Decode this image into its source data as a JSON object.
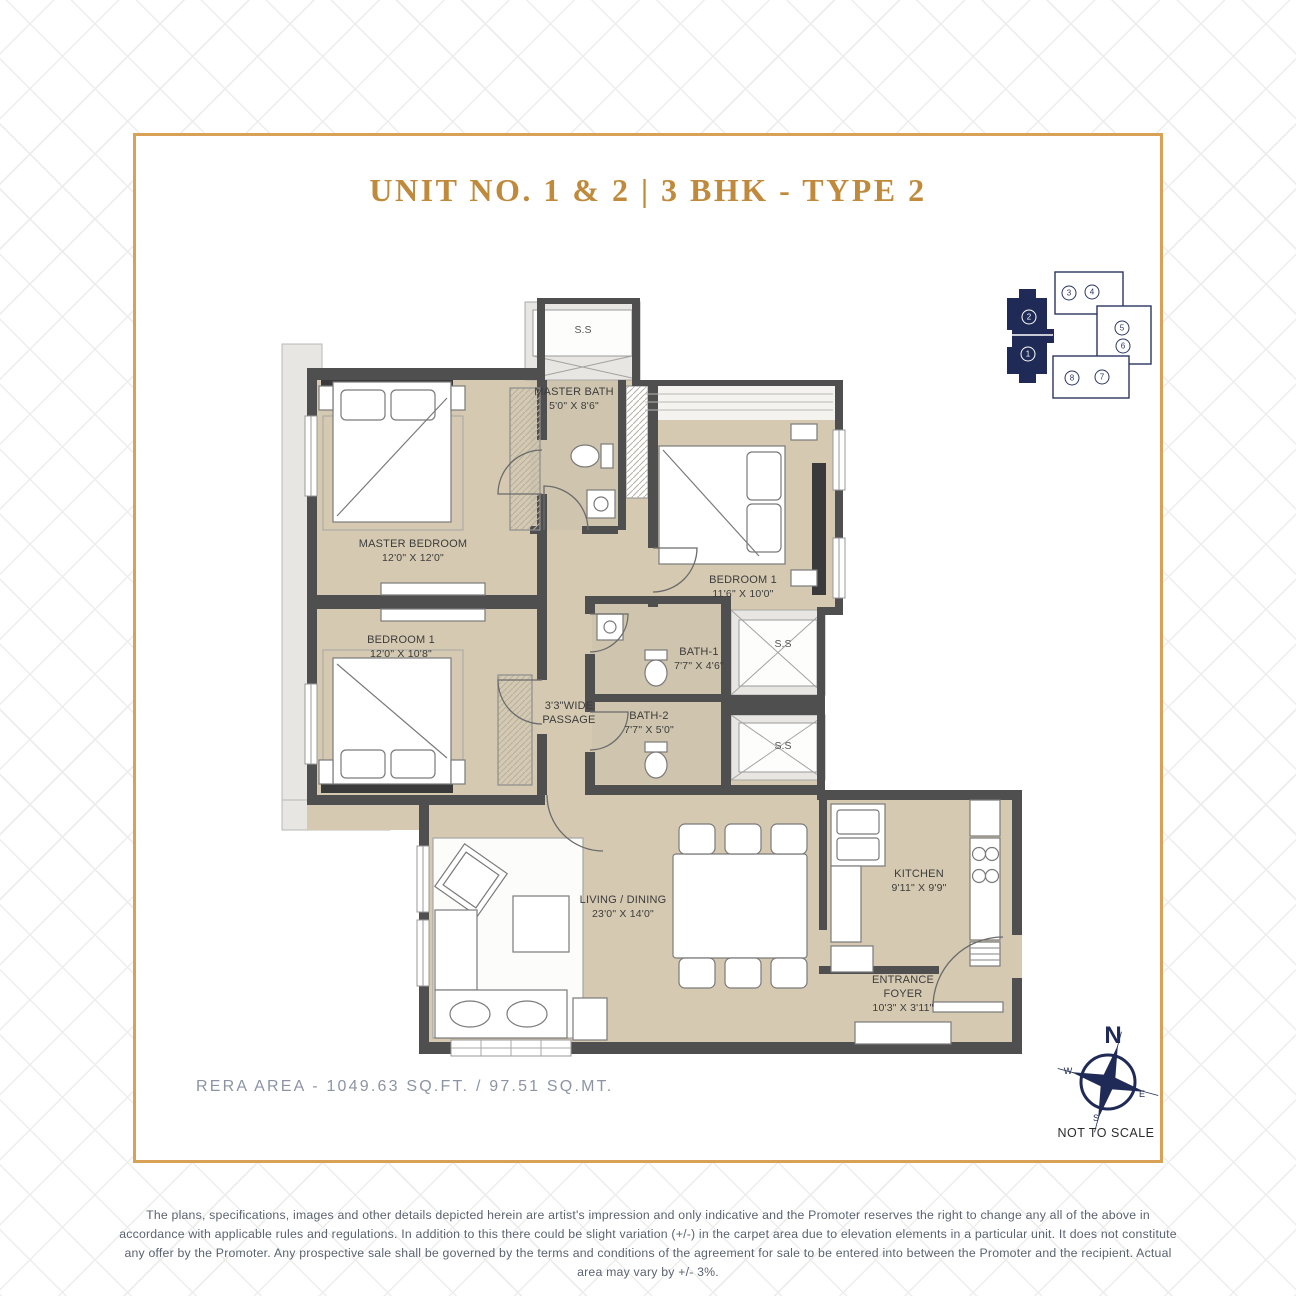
{
  "title": "UNIT NO. 1 & 2 | 3 BHK - TYPE 2",
  "key_plan": {
    "units": [
      "2",
      "1",
      "3",
      "4",
      "5",
      "6",
      "8",
      "7"
    ]
  },
  "plan": {
    "shaft_label": "S.S",
    "rooms": {
      "master_bedroom": {
        "name": "MASTER BEDROOM",
        "dims": "12'0\" X 12'0\""
      },
      "bedroom1_left": {
        "name": "BEDROOM 1",
        "dims": "12'0\" X 10'8\""
      },
      "bedroom1_right": {
        "name": "BEDROOM 1",
        "dims": "11'6\" X 10'0\""
      },
      "master_bath": {
        "name": "MASTER BATH",
        "dims": "5'0\" X 8'6\""
      },
      "bath1": {
        "name": "BATH-1",
        "dims": "7'7\" X 4'6\""
      },
      "bath2": {
        "name": "BATH-2",
        "dims": "7'7\" X 5'0\""
      },
      "living_dining": {
        "name": "LIVING / DINING",
        "dims": "23'0\" X 14'0\""
      },
      "kitchen": {
        "name": "KITCHEN",
        "dims": "9'11\" X 9'9\""
      },
      "entrance_foyer": {
        "name": "ENTRANCE FOYER",
        "dims": "10'3\" X 3'11\""
      },
      "passage": {
        "name": "3'3\"WIDE PASSAGE"
      }
    }
  },
  "compass": {
    "n": "N",
    "w": "W",
    "e": "E",
    "s": "S",
    "note": "NOT TO SCALE"
  },
  "area_note": "RERA AREA - 1049.63 SQ.FT. / 97.51 SQ.MT.",
  "disclaimer": "The plans, specifications, images and other details depicted herein are artist's impression and only indicative and the Promoter reserves the right to change any all of the above in accordance with applicable rules and regulations. In addition to this there could be slight variation (+/-) in the carpet area due to elevation elements in a particular unit. It does not constitute any offer by the Promoter. Any prospective sale shall be governed by the terms and conditions of the agreement for sale to be entered into between the Promoter and the recipient. Actual area may vary by +/- 3%.",
  "colors": {
    "accent_gold": "#d8a155",
    "navy": "#1f2b56",
    "floor_beige": "#d5cab1",
    "wall_gray": "#4f4f4f"
  }
}
